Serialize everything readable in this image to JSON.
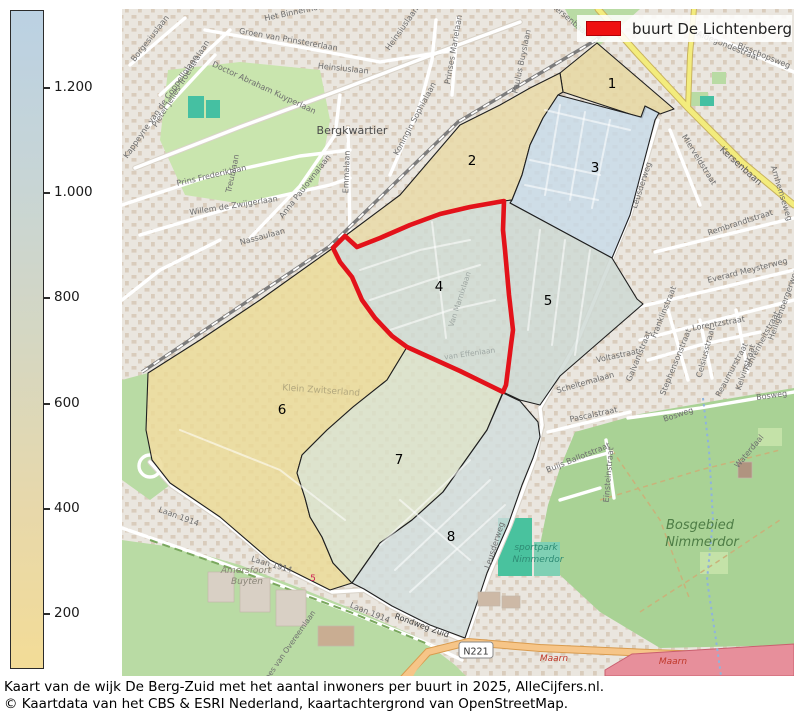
{
  "legend": {
    "label": "buurt De Lichtenberg",
    "swatch_color": "#ee1010"
  },
  "highlight": {
    "region": "4",
    "outline_color": "#e3121a"
  },
  "colorbar": {
    "gradient": [
      "#f3dc97",
      "#e7d8ab",
      "#d5d7c2",
      "#c7d5d6",
      "#bbd1e3"
    ],
    "ticks": [
      {
        "label": "1.200",
        "y": 88
      },
      {
        "label": "1.000",
        "y": 193
      },
      {
        "label": "800",
        "y": 298
      },
      {
        "label": "600",
        "y": 404
      },
      {
        "label": "400",
        "y": 509
      },
      {
        "label": "200",
        "y": 614
      }
    ]
  },
  "regions": [
    {
      "number": "1",
      "x": 612,
      "y": 88,
      "fill": "#e7d7a0"
    },
    {
      "number": "2",
      "x": 472,
      "y": 165,
      "fill": "#e9d9a6"
    },
    {
      "number": "3",
      "x": 595,
      "y": 172,
      "fill": "#c8dbe9"
    },
    {
      "number": "4",
      "x": 439,
      "y": 291,
      "fill": "#d0dad3"
    },
    {
      "number": "5",
      "x": 548,
      "y": 305,
      "fill": "#cdd8d3"
    },
    {
      "number": "6",
      "x": 282,
      "y": 414,
      "fill": "#ecdb96"
    },
    {
      "number": "7",
      "x": 399,
      "y": 464,
      "fill": "#dbe2c9"
    },
    {
      "number": "8",
      "x": 451,
      "y": 541,
      "fill": "#d2dddd"
    }
  ],
  "map": {
    "shield": {
      "text": "N221",
      "x": 476,
      "y": 651
    },
    "labels": [
      {
        "t": "Het Binnenhof",
        "x": 293,
        "y": 15,
        "r": -12
      },
      {
        "t": "Borgesiuslaan",
        "x": 152,
        "y": 40,
        "r": -52
      },
      {
        "t": "Pieter Jelles Troelstralaan",
        "x": 183,
        "y": 85,
        "r": -58
      },
      {
        "t": "Groen van Prinstererlaan",
        "x": 288,
        "y": 42,
        "r": 10
      },
      {
        "t": "Heinsiuslaan",
        "x": 343,
        "y": 71,
        "r": 6
      },
      {
        "t": "Heinsiuslaan",
        "x": 404,
        "y": 30,
        "r": -55
      },
      {
        "t": "Doctor Abraham Kuyperlaan",
        "x": 263,
        "y": 90,
        "r": 25
      },
      {
        "t": "Bergkwartier",
        "x": 352,
        "y": 134,
        "r": 0,
        "s": 11,
        "c": "#4a4a4a"
      },
      {
        "t": "Kappeyne van de Coppellolaan",
        "x": 163,
        "y": 108,
        "r": -55
      },
      {
        "t": "Prins Frederiklaan",
        "x": 212,
        "y": 178,
        "r": -13
      },
      {
        "t": "Willem de Zwijgerlaan",
        "x": 234,
        "y": 208,
        "r": -9
      },
      {
        "t": "Anna Paulownalaan",
        "x": 307,
        "y": 188,
        "r": -52
      },
      {
        "t": "Emmalaan",
        "x": 349,
        "y": 172,
        "r": -88
      },
      {
        "t": "Treublaan",
        "x": 235,
        "y": 174,
        "r": -78
      },
      {
        "t": "Nassaulaan",
        "x": 263,
        "y": 239,
        "r": -15
      },
      {
        "t": "Prinses Marielaan",
        "x": 456,
        "y": 50,
        "r": -80
      },
      {
        "t": "Koningin Sophialaan",
        "x": 417,
        "y": 120,
        "r": -62
      },
      {
        "t": "Paulus Buyslaan",
        "x": 524,
        "y": 62,
        "r": -78
      },
      {
        "t": "Kersenbaan",
        "x": 739,
        "y": 168,
        "r": 42,
        "s": 9,
        "c": "#5a5a5a"
      },
      {
        "t": "Kersenbaan",
        "x": 569,
        "y": 22,
        "r": 40
      },
      {
        "t": "Arnhemseweg",
        "x": 779,
        "y": 194,
        "r": 73
      },
      {
        "t": "Mierveldstraat",
        "x": 697,
        "y": 161,
        "r": 58
      },
      {
        "t": "Rembrandtstraat",
        "x": 741,
        "y": 225,
        "r": -18
      },
      {
        "t": "Everard Meysterweg",
        "x": 748,
        "y": 273,
        "r": -14
      },
      {
        "t": "Bisschopsweg",
        "x": 763,
        "y": 58,
        "r": 22
      },
      {
        "t": "Aldegondestraat",
        "x": 727,
        "y": 48,
        "r": 22
      },
      {
        "t": "Lorentzstraat",
        "x": 719,
        "y": 326,
        "r": -10
      },
      {
        "t": "Franklinstraat",
        "x": 666,
        "y": 313,
        "r": -68
      },
      {
        "t": "Celsiusstraat",
        "x": 708,
        "y": 353,
        "r": -75
      },
      {
        "t": "Stephensonstraat",
        "x": 678,
        "y": 363,
        "r": -68
      },
      {
        "t": "Galvanistraat",
        "x": 641,
        "y": 357,
        "r": -68
      },
      {
        "t": "Reaumurstraat",
        "x": 734,
        "y": 371,
        "r": -62
      },
      {
        "t": "Kelvinstraat",
        "x": 748,
        "y": 368,
        "r": -72
      },
      {
        "t": "Fahrenheitstraat",
        "x": 764,
        "y": 342,
        "r": -62
      },
      {
        "t": "Voltastraat",
        "x": 618,
        "y": 358,
        "r": -12
      },
      {
        "t": "Scheltemalaan",
        "x": 586,
        "y": 385,
        "r": -16
      },
      {
        "t": "Pascalstraat",
        "x": 594,
        "y": 417,
        "r": -12
      },
      {
        "t": "Buijs Ballotstraat",
        "x": 579,
        "y": 460,
        "r": -22
      },
      {
        "t": "Einsteinstraat",
        "x": 611,
        "y": 475,
        "r": -85
      },
      {
        "t": "Leusderweg",
        "x": 644,
        "y": 186,
        "r": -72
      },
      {
        "t": "Leusderweg",
        "x": 497,
        "y": 546,
        "r": -72
      },
      {
        "t": "Bosweg",
        "x": 679,
        "y": 417,
        "r": -18
      },
      {
        "t": "Bosweg",
        "x": 772,
        "y": 398,
        "r": -8
      },
      {
        "t": "Waterdaal",
        "x": 751,
        "y": 453,
        "r": -50
      },
      {
        "t": "Heiligenbergerweg",
        "x": 786,
        "y": 305,
        "r": -70
      },
      {
        "t": "Bosgebied",
        "x": 700,
        "y": 529,
        "s": 13,
        "c": "#4e7d46",
        "i": true
      },
      {
        "t": "Nimmerdor",
        "x": 702,
        "y": 546,
        "s": 13,
        "c": "#4e7d46",
        "i": true
      },
      {
        "t": "sportpark",
        "x": 536,
        "y": 550,
        "s": 9,
        "c": "#2e8b74",
        "i": true
      },
      {
        "t": "Nimmerdor",
        "x": 538,
        "y": 562,
        "s": 9,
        "c": "#2e8b74",
        "i": true
      },
      {
        "t": "Amersfoort",
        "x": 246,
        "y": 573,
        "s": 9,
        "c": "#8a8578",
        "i": true
      },
      {
        "t": "Buyten",
        "x": 247,
        "y": 584,
        "s": 9,
        "c": "#8a8578",
        "i": true
      },
      {
        "t": "Laan 1914",
        "x": 178,
        "y": 519,
        "r": 20
      },
      {
        "t": "Laan 1914",
        "x": 271,
        "y": 567,
        "r": 16
      },
      {
        "t": "Laan 1914",
        "x": 369,
        "y": 615,
        "r": 22
      },
      {
        "t": "Rondweg Zuid",
        "x": 421,
        "y": 628,
        "r": 20,
        "c": "#3c3c3c"
      },
      {
        "t": "Loes van Overeemlaan",
        "x": 291,
        "y": 648,
        "r": -55,
        "s": 7.5
      },
      {
        "t": "Klein Zwitserland",
        "x": 321,
        "y": 393,
        "r": 4,
        "s": 9,
        "c": "#b3a87e"
      },
      {
        "t": "Maarn",
        "x": 554,
        "y": 661,
        "s": 9,
        "c": "#c0392b",
        "i": true
      },
      {
        "t": "Maarn",
        "x": 673,
        "y": 664,
        "s": 9,
        "c": "#c0392b",
        "i": true
      },
      {
        "t": "5",
        "x": 313,
        "y": 581,
        "s": 9,
        "c": "#cc2255"
      },
      {
        "t": "van Effenlaan",
        "x": 470,
        "y": 356,
        "r": -8,
        "s": 7.5,
        "c": "#9fa8a4"
      },
      {
        "t": "Van Marnixlaan",
        "x": 462,
        "y": 300,
        "r": -72,
        "s": 7.5,
        "c": "#9fa8a4"
      }
    ]
  },
  "caption": {
    "line1": "Kaart van de wijk De Berg-Zuid met het aantal inwoners per buurt in 2025, AlleCijfers.nl.",
    "line2": "© Kaartdata van het CBS & ESRI Nederland, kaartachtergrond van OpenStreetMap."
  }
}
